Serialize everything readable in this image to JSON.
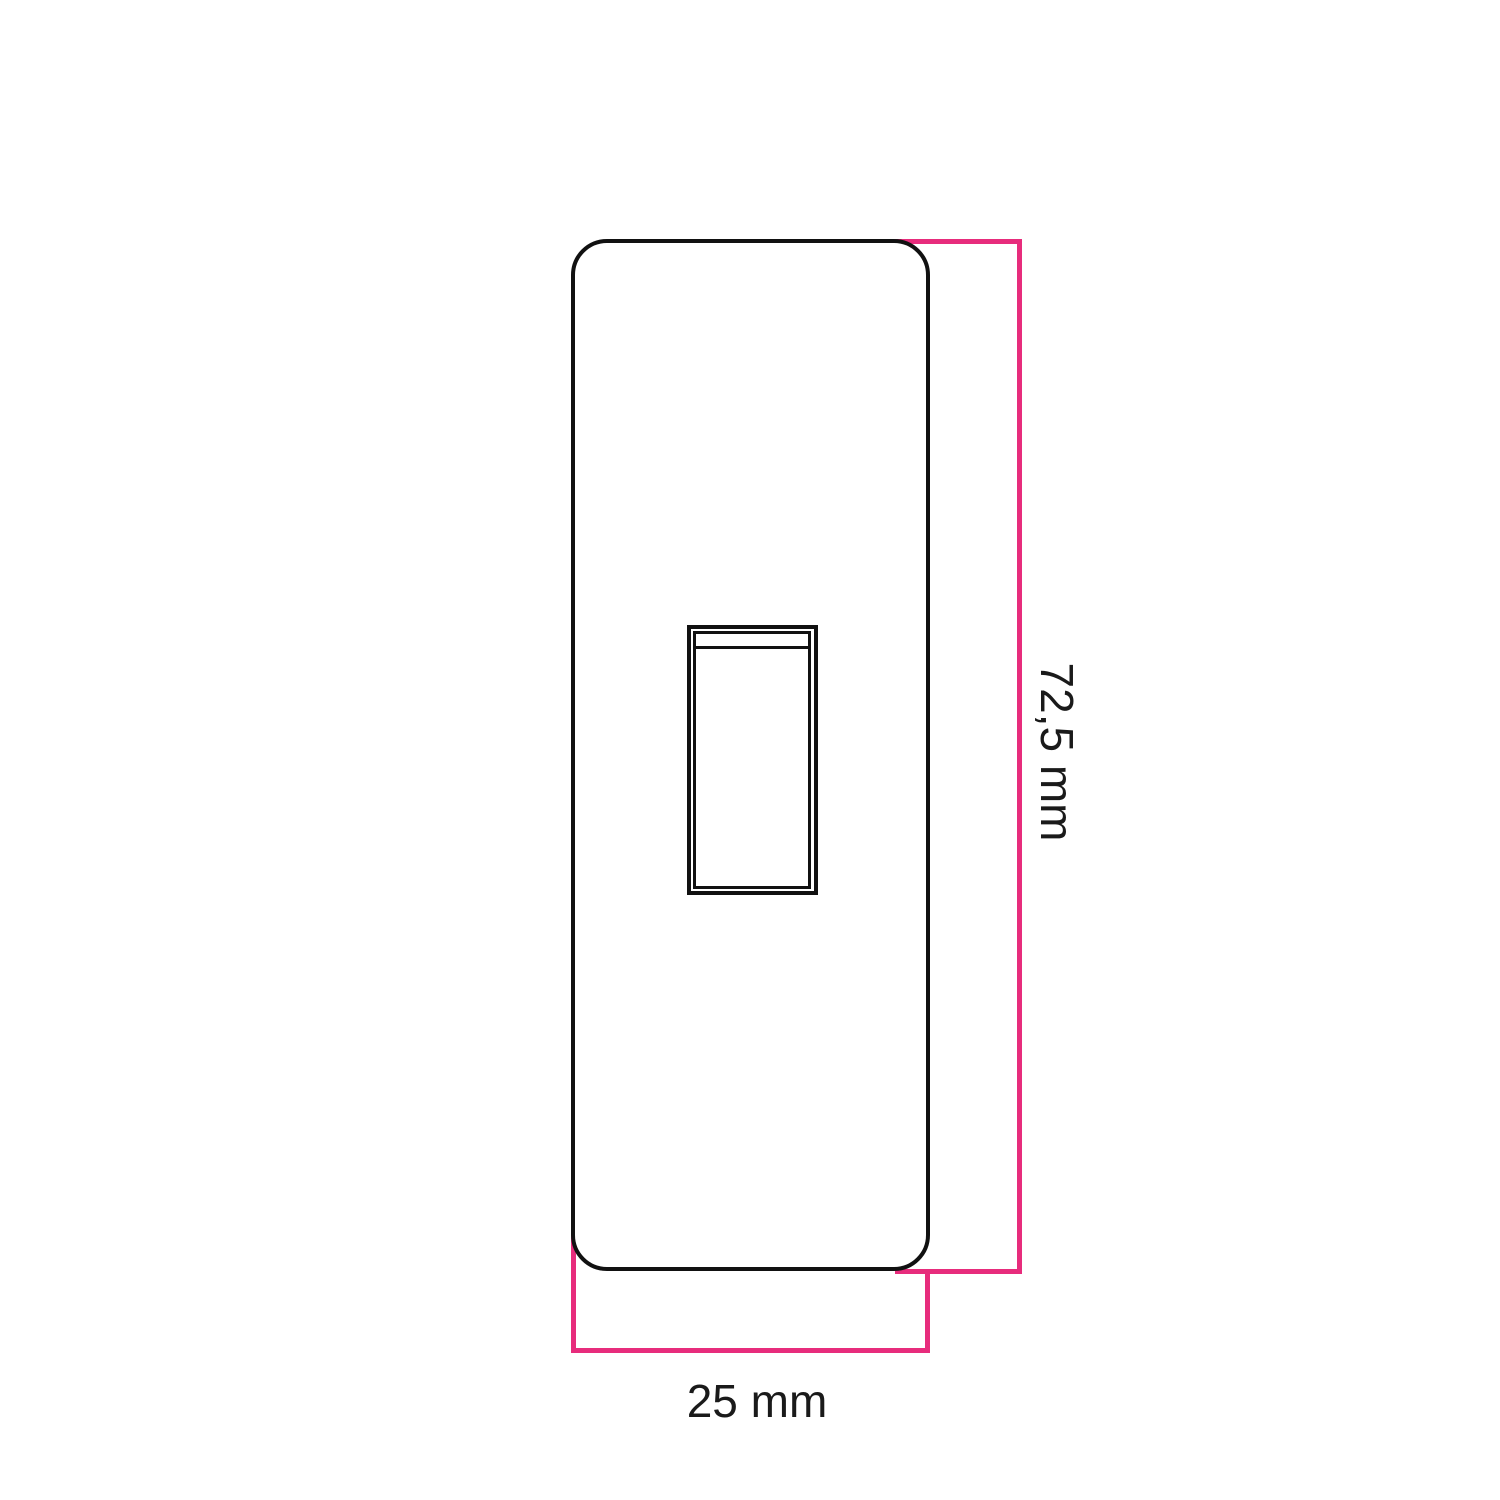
{
  "diagram": {
    "dimensions": {
      "height_label": "72,5 mm",
      "width_label": "25 mm"
    },
    "colors": {
      "outline": "#111111",
      "dimension": "#E72C7C",
      "background": "#FFFFFF",
      "text": "#1A1A1A"
    }
  }
}
